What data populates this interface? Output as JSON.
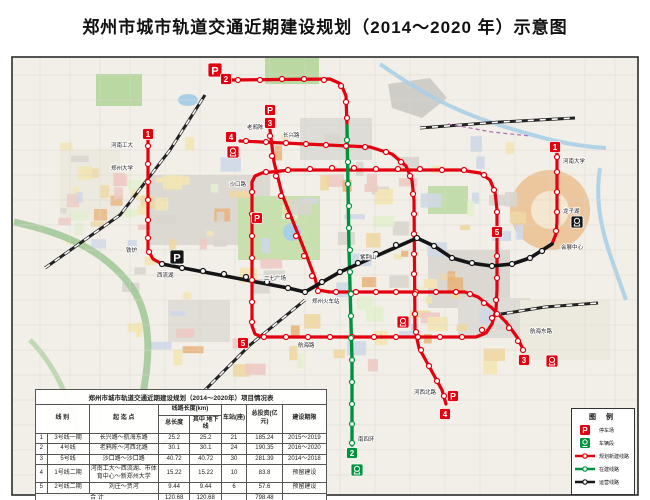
{
  "title": "郑州市城市轨道交通近期建设规划（2014～2020 年）示意图",
  "map": {
    "frame_color": "#2b2b2b",
    "bg_color": "#f1efe8",
    "lines": [
      {
        "id": "line5-loop",
        "name": "5号线(环线)",
        "status": "planned",
        "color": "#e3000f",
        "width": 3.2,
        "points": [
          [
            252,
            182
          ],
          [
            252,
            326
          ],
          [
            255,
            334
          ],
          [
            262,
            337
          ],
          [
            476,
            337
          ],
          [
            486,
            333
          ],
          [
            492,
            324
          ],
          [
            496,
            310
          ],
          [
            497,
            290
          ],
          [
            497,
            210
          ],
          [
            495,
            192
          ],
          [
            490,
            180
          ],
          [
            480,
            173
          ],
          [
            460,
            170
          ],
          [
            290,
            170
          ],
          [
            262,
            173
          ],
          [
            255,
            176
          ],
          [
            252,
            182
          ]
        ],
        "stations": [
          [
            252,
            192
          ],
          [
            252,
            214
          ],
          [
            252,
            236
          ],
          [
            252,
            258
          ],
          [
            252,
            280
          ],
          [
            252,
            302
          ],
          [
            252,
            322
          ],
          [
            264,
            337
          ],
          [
            286,
            337
          ],
          [
            308,
            337
          ],
          [
            330,
            337
          ],
          [
            352,
            337
          ],
          [
            374,
            337
          ],
          [
            396,
            337
          ],
          [
            418,
            337
          ],
          [
            440,
            337
          ],
          [
            462,
            337
          ],
          [
            482,
            330
          ],
          [
            492,
            318
          ],
          [
            496,
            300
          ],
          [
            497,
            278
          ],
          [
            497,
            256
          ],
          [
            497,
            234
          ],
          [
            497,
            212
          ],
          [
            494,
            190
          ],
          [
            484,
            175
          ],
          [
            464,
            170
          ],
          [
            442,
            170
          ],
          [
            420,
            169
          ],
          [
            398,
            169
          ],
          [
            376,
            169
          ],
          [
            354,
            168
          ],
          [
            332,
            168
          ],
          [
            310,
            169
          ],
          [
            288,
            170
          ],
          [
            266,
            172
          ]
        ]
      },
      {
        "id": "line3",
        "name": "3号线一期",
        "status": "planned",
        "color": "#e3000f",
        "width": 3.2,
        "points": [
          [
            270,
            130
          ],
          [
            274,
            162
          ],
          [
            282,
            194
          ],
          [
            294,
            224
          ],
          [
            306,
            254
          ],
          [
            315,
            278
          ],
          [
            318,
            290
          ],
          [
            330,
            292
          ],
          [
            465,
            292
          ],
          [
            478,
            297
          ],
          [
            492,
            308
          ],
          [
            506,
            322
          ],
          [
            517,
            337
          ],
          [
            524,
            351
          ]
        ],
        "stations": [
          [
            270,
            136
          ],
          [
            272,
            156
          ],
          [
            276,
            176
          ],
          [
            281,
            196
          ],
          [
            288,
            216
          ],
          [
            296,
            236
          ],
          [
            304,
            256
          ],
          [
            312,
            276
          ],
          [
            318,
            291
          ],
          [
            336,
            292
          ],
          [
            356,
            292
          ],
          [
            376,
            292
          ],
          [
            396,
            292
          ],
          [
            416,
            292
          ],
          [
            436,
            292
          ],
          [
            456,
            292
          ],
          [
            470,
            294
          ],
          [
            484,
            303
          ],
          [
            497,
            314
          ],
          [
            509,
            328
          ],
          [
            518,
            341
          ],
          [
            523,
            350
          ]
        ]
      },
      {
        "id": "line4",
        "name": "4号线",
        "status": "planned",
        "color": "#e3000f",
        "width": 3.2,
        "points": [
          [
            240,
            141
          ],
          [
            370,
            147
          ],
          [
            392,
            154
          ],
          [
            406,
            166
          ],
          [
            412,
            180
          ],
          [
            414,
            200
          ],
          [
            415,
            330
          ],
          [
            419,
            348
          ],
          [
            430,
            368
          ],
          [
            442,
            390
          ],
          [
            446,
            404
          ]
        ],
        "stations": [
          [
            246,
            141
          ],
          [
            266,
            142
          ],
          [
            286,
            143
          ],
          [
            306,
            144
          ],
          [
            326,
            145
          ],
          [
            346,
            146
          ],
          [
            365,
            147
          ],
          [
            386,
            152
          ],
          [
            401,
            162
          ],
          [
            410,
            176
          ],
          [
            413,
            194
          ],
          [
            414,
            214
          ],
          [
            414,
            234
          ],
          [
            414,
            254
          ],
          [
            414,
            274
          ],
          [
            415,
            294
          ],
          [
            415,
            314
          ],
          [
            416,
            332
          ],
          [
            421,
            350
          ],
          [
            429,
            366
          ],
          [
            437,
            381
          ],
          [
            444,
            396
          ]
        ]
      },
      {
        "id": "line2-north",
        "name": "2号线二期",
        "status": "planned",
        "color": "#e3000f",
        "width": 3.2,
        "points": [
          [
            228,
            80
          ],
          [
            330,
            79
          ],
          [
            341,
            84
          ],
          [
            346,
            96
          ],
          [
            347,
            126
          ]
        ],
        "stations": [
          [
            238,
            80
          ],
          [
            260,
            80
          ],
          [
            282,
            79
          ],
          [
            304,
            79
          ],
          [
            324,
            80
          ],
          [
            341,
            86
          ],
          [
            346,
            102
          ],
          [
            347,
            118
          ]
        ]
      },
      {
        "id": "line1-west",
        "name": "1号线二期(西段)",
        "status": "planned",
        "color": "#e3000f",
        "width": 3.2,
        "points": [
          [
            148,
            140
          ],
          [
            148,
            250
          ],
          [
            153,
            259
          ],
          [
            162,
            264
          ]
        ],
        "stations": [
          [
            148,
            146
          ],
          [
            148,
            164
          ],
          [
            148,
            182
          ],
          [
            148,
            200
          ],
          [
            148,
            220
          ],
          [
            148,
            238
          ],
          [
            149,
            252
          ]
        ]
      },
      {
        "id": "line1-east",
        "name": "1号线二期(东段)",
        "status": "planned",
        "color": "#e3000f",
        "width": 3.2,
        "points": [
          [
            552,
            244
          ],
          [
            556,
            234
          ],
          [
            557,
            222
          ],
          [
            557,
            152
          ]
        ],
        "stations": [
          [
            556,
            231
          ],
          [
            557,
            212
          ],
          [
            557,
            192
          ],
          [
            557,
            172
          ],
          [
            557,
            157
          ]
        ]
      },
      {
        "id": "line2",
        "name": "2号线一期",
        "status": "under-construction",
        "color": "#00923f",
        "width": 3.4,
        "points": [
          [
            347,
            126
          ],
          [
            349,
            250
          ],
          [
            352,
            360
          ],
          [
            352,
            445
          ]
        ],
        "stations": [
          [
            347,
            140
          ],
          [
            348,
            162
          ],
          [
            348,
            184
          ],
          [
            349,
            206
          ],
          [
            349,
            228
          ],
          [
            350,
            250
          ],
          [
            350,
            272
          ],
          [
            351,
            294
          ],
          [
            351,
            316
          ],
          [
            351,
            338
          ],
          [
            352,
            360
          ],
          [
            352,
            382
          ],
          [
            352,
            404
          ],
          [
            352,
            424
          ],
          [
            352,
            443
          ]
        ]
      },
      {
        "id": "line1",
        "name": "1号线一期",
        "status": "operating",
        "color": "#151515",
        "width": 3.6,
        "points": [
          [
            162,
            264
          ],
          [
            288,
            288
          ],
          [
            305,
            292
          ],
          [
            340,
            272
          ],
          [
            417,
            238
          ],
          [
            434,
            246
          ],
          [
            452,
            258
          ],
          [
            470,
            263
          ],
          [
            492,
            266
          ],
          [
            512,
            264
          ],
          [
            530,
            258
          ],
          [
            552,
            244
          ]
        ],
        "stations": [
          [
            162,
            264
          ],
          [
            182,
            268
          ],
          [
            203,
            271
          ],
          [
            224,
            274
          ],
          [
            246,
            277
          ],
          [
            267,
            282
          ],
          [
            288,
            288
          ],
          [
            305,
            292
          ],
          [
            322,
            282
          ],
          [
            340,
            272
          ],
          [
            358,
            263
          ],
          [
            376,
            254
          ],
          [
            396,
            245
          ],
          [
            417,
            238
          ],
          [
            434,
            246
          ],
          [
            452,
            258
          ],
          [
            472,
            263
          ],
          [
            492,
            266
          ],
          [
            512,
            264
          ],
          [
            530,
            258
          ],
          [
            542,
            251
          ]
        ]
      }
    ],
    "badges": [
      {
        "label": "1",
        "x": 148,
        "y": 134,
        "color": "#e3000f"
      },
      {
        "label": "1",
        "x": 555,
        "y": 147,
        "color": "#e3000f"
      },
      {
        "label": "2",
        "x": 226,
        "y": 79,
        "color": "#e3000f"
      },
      {
        "label": "3",
        "x": 270,
        "y": 123,
        "color": "#e3000f"
      },
      {
        "label": "3",
        "x": 524,
        "y": 360,
        "color": "#e3000f"
      },
      {
        "label": "4",
        "x": 231,
        "y": 137,
        "color": "#e3000f"
      },
      {
        "label": "4",
        "x": 445,
        "y": 414,
        "color": "#e3000f"
      },
      {
        "label": "5",
        "x": 243,
        "y": 343,
        "color": "#e3000f"
      },
      {
        "label": "5",
        "x": 497,
        "y": 232,
        "color": "#e3000f"
      },
      {
        "label": "2",
        "x": 352,
        "y": 453,
        "color": "#00923f"
      }
    ],
    "p_icons": [
      {
        "x": 215,
        "y": 70,
        "color": "#e3000f",
        "size": 14
      },
      {
        "x": 177,
        "y": 257,
        "color": "#151515",
        "size": 14
      },
      {
        "x": 270,
        "y": 110,
        "color": "#e3000f",
        "size": 11
      },
      {
        "x": 257,
        "y": 218,
        "color": "#e3000f",
        "size": 11
      },
      {
        "x": 453,
        "y": 396,
        "color": "#e3000f",
        "size": 11
      }
    ],
    "depot_icons": [
      {
        "x": 233,
        "y": 152,
        "color": "#e3000f"
      },
      {
        "x": 403,
        "y": 322,
        "color": "#e3000f"
      },
      {
        "x": 552,
        "y": 361,
        "color": "#e3000f"
      },
      {
        "x": 357,
        "y": 470,
        "color": "#00923f"
      },
      {
        "x": 577,
        "y": 222,
        "color": "#151515"
      }
    ],
    "labels": [
      {
        "text": "老鸦陈",
        "x": 247,
        "y": 129,
        "anchor": "start"
      },
      {
        "text": "长兴路",
        "x": 283,
        "y": 137,
        "anchor": "start"
      },
      {
        "text": "河南工大",
        "x": 133,
        "y": 147,
        "anchor": "end"
      },
      {
        "text": "郑州大学",
        "x": 133,
        "y": 170,
        "anchor": "end"
      },
      {
        "text": "铁炉",
        "x": 137,
        "y": 252,
        "anchor": "end"
      },
      {
        "text": "西流湖",
        "x": 157,
        "y": 277,
        "anchor": "start"
      },
      {
        "text": "沙口路",
        "x": 246,
        "y": 186,
        "anchor": "end"
      },
      {
        "text": "二七广场",
        "x": 286,
        "y": 280,
        "anchor": "end"
      },
      {
        "text": "郑州火车站",
        "x": 312,
        "y": 303,
        "anchor": "start"
      },
      {
        "text": "紫荆山",
        "x": 360,
        "y": 259,
        "anchor": "start"
      },
      {
        "text": "会展中心",
        "x": 561,
        "y": 249,
        "anchor": "start"
      },
      {
        "text": "龙子湖",
        "x": 563,
        "y": 213,
        "anchor": "start"
      },
      {
        "text": "河南大学",
        "x": 563,
        "y": 163,
        "anchor": "start"
      },
      {
        "text": "航海东路",
        "x": 530,
        "y": 333,
        "anchor": "start"
      },
      {
        "text": "河西北路",
        "x": 436,
        "y": 394,
        "anchor": "end"
      },
      {
        "text": "南四环",
        "x": 358,
        "y": 441,
        "anchor": "start"
      },
      {
        "text": "航海路",
        "x": 298,
        "y": 347,
        "anchor": "start"
      }
    ]
  },
  "table": {
    "title": "郑州市城市轨道交通近期建设规划（2014～2020年）项目情况表",
    "headers": {
      "line": "线  别",
      "endpoints": "起  迄  点",
      "length_group": "线路长度(km)",
      "length_total": "总长度",
      "length_underground": "其中 地下线",
      "stations": "车站(座)",
      "investment": "总投资(亿元)",
      "period": "建设期限"
    },
    "rows": [
      {
        "no": "1",
        "line": "3号线一期",
        "endpoints": "长兴路～航海东路",
        "length": "25.2",
        "underground": "25.2",
        "stations": "21",
        "investment": "185.24",
        "period": "2015～2019"
      },
      {
        "no": "2",
        "line": "4号线",
        "endpoints": "老鸦陈～河西北路",
        "length": "30.1",
        "underground": "30.1",
        "stations": "24",
        "investment": "190.35",
        "period": "2016～2020"
      },
      {
        "no": "3",
        "line": "5号线",
        "endpoints": "沙口路～沙口路",
        "length": "40.72",
        "underground": "40.72",
        "stations": "30",
        "investment": "281.39",
        "period": "2014～2018"
      },
      {
        "no": "4",
        "line": "1号线二期",
        "endpoints": "河南工大～西流湖、市体育中心～新郑州大学",
        "length": "15.22",
        "underground": "15.22",
        "stations": "10",
        "investment": "83.8",
        "period": "预留建设"
      },
      {
        "no": "5",
        "line": "2号线二期",
        "endpoints": "刘庄～贾河",
        "length": "9.44",
        "underground": "9.44",
        "stations": "6",
        "investment": "57.6",
        "period": "预留建设"
      }
    ],
    "total": {
      "label": "合  计",
      "length": "120.68",
      "underground": "120.68",
      "stations": "",
      "investment": "798.48",
      "period": ""
    }
  },
  "legend": {
    "title": "图 例",
    "items": [
      {
        "icon": "p-red",
        "label": "停车场"
      },
      {
        "icon": "depot-green",
        "label": "车辆段"
      },
      {
        "icon": "line-red",
        "label": "规划新建线路"
      },
      {
        "icon": "line-green",
        "label": "在建线路"
      },
      {
        "icon": "line-black",
        "label": "运营线路"
      }
    ]
  }
}
